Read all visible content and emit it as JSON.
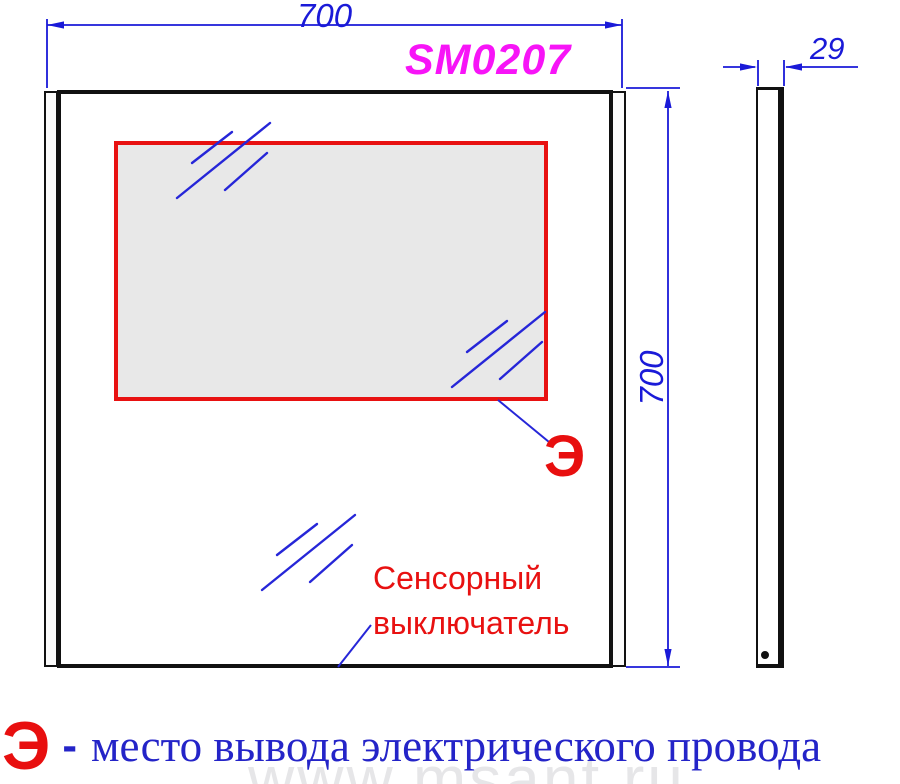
{
  "drawing": {
    "model": "SM0207",
    "width_mm": "700",
    "height_mm": "700",
    "depth_mm": "29",
    "electrical_symbol": "Э",
    "touch_switch_label": {
      "line1": "Сенсорный",
      "line2": "выключатель"
    },
    "legend": {
      "symbol": "Э",
      "separator": "-",
      "description": "место вывода электрического провода"
    },
    "watermark": "www.msant.ru",
    "colors": {
      "dimension_blue": "#1a1ad8",
      "hatch_blue": "#2626d8",
      "accent_red": "#e81111",
      "model_magenta": "#f714f7",
      "legend_blue": "#2424c8",
      "led_zone_fill": "#e8e8e8",
      "outline_black": "#111111"
    }
  }
}
